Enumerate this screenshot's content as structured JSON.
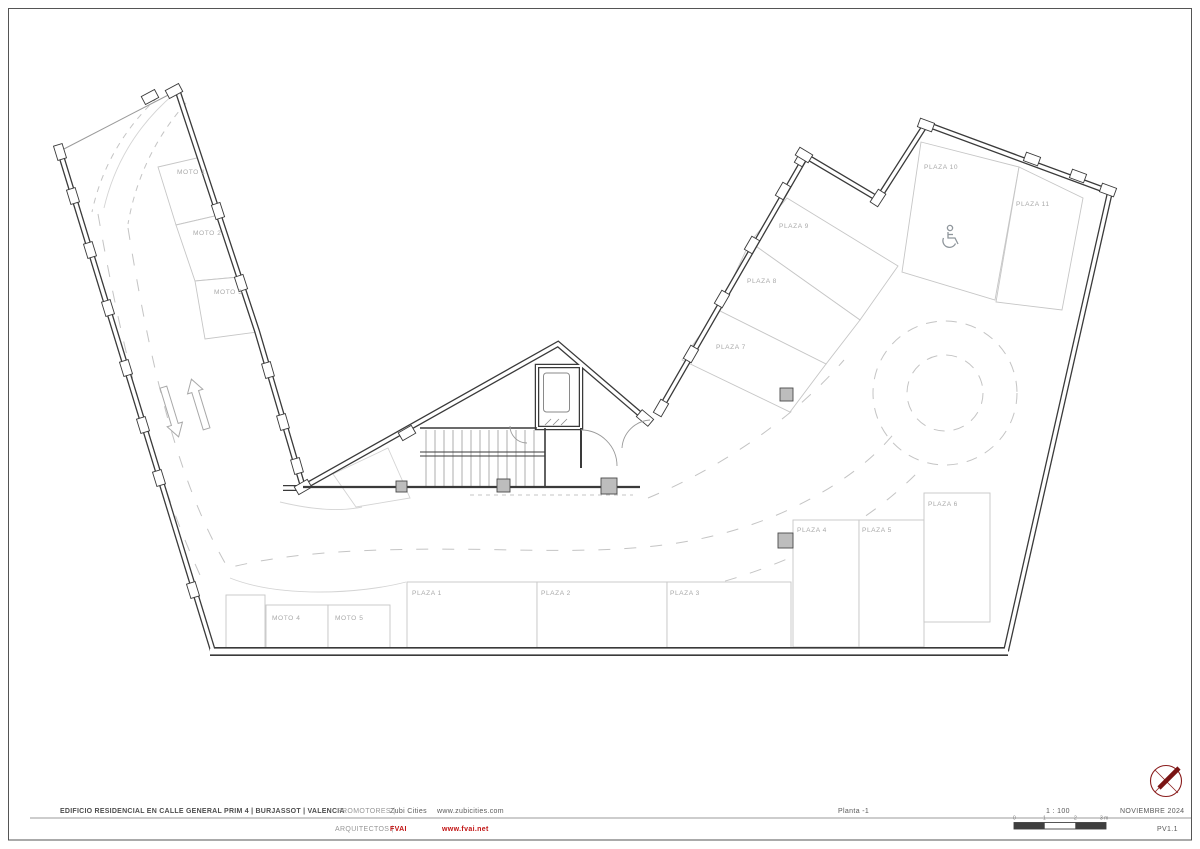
{
  "title_block": {
    "project_title": "EDIFICIO RESIDENCIAL EN CALLE GENERAL PRIM 4 | BURJASSOT | VALENCIA",
    "promoters_label": "PROMOTORES |",
    "promoters_name": "Zubi Cities",
    "promoters_url": "www.zubicities.com",
    "architects_label": "ARQUITECTOS |",
    "architects_name": "FVAI",
    "architects_url": "www.fvai.net",
    "sheet_name": "Planta -1",
    "scale": "1 : 100",
    "date": "NOVIEMBRE 2024",
    "sheet_code": "PV1.1",
    "accent_red": "#c11212",
    "scale_bar_ticks": [
      "0",
      "1",
      "2",
      "3 m"
    ]
  },
  "plan": {
    "icons": {
      "wheelchair": "wheelchair-icon",
      "north_arrow": "north-arrow-icon",
      "direction_arrows": "two-way-ramp-arrows"
    },
    "colors": {
      "wall": "#3a3a3a",
      "space_outline": "#c6c6c6",
      "label_gray": "#a9a9a9"
    },
    "spaces": [
      {
        "id": "moto-1",
        "label": "MOTO 1"
      },
      {
        "id": "moto-2",
        "label": "MOTO 2"
      },
      {
        "id": "moto-3",
        "label": "MOTO 3"
      },
      {
        "id": "moto-4",
        "label": "MOTO 4"
      },
      {
        "id": "moto-5",
        "label": "MOTO 5"
      },
      {
        "id": "plaza-1",
        "label": "PLAZA 1"
      },
      {
        "id": "plaza-2",
        "label": "PLAZA 2"
      },
      {
        "id": "plaza-3",
        "label": "PLAZA 3"
      },
      {
        "id": "plaza-4",
        "label": "PLAZA 4"
      },
      {
        "id": "plaza-5",
        "label": "PLAZA 5"
      },
      {
        "id": "plaza-6",
        "label": "PLAZA 6"
      },
      {
        "id": "plaza-7",
        "label": "PLAZA 7"
      },
      {
        "id": "plaza-8",
        "label": "PLAZA 8"
      },
      {
        "id": "plaza-9",
        "label": "PLAZA 9"
      },
      {
        "id": "plaza-10",
        "label": "PLAZA 10"
      },
      {
        "id": "plaza-11",
        "label": "PLAZA 11"
      }
    ]
  }
}
